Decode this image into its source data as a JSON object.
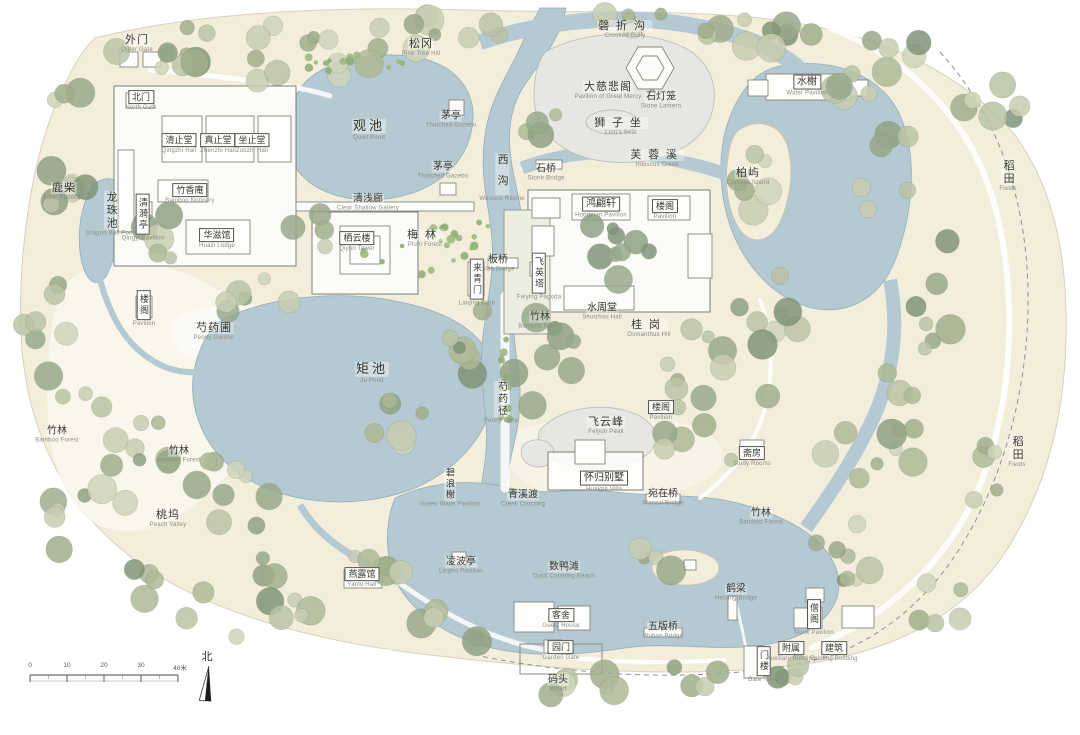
{
  "map": {
    "compass": {
      "label": "北"
    },
    "scale_bar": {
      "ticks": [
        "0",
        "10",
        "20",
        "30"
      ],
      "end_label": "40米"
    },
    "colors": {
      "paper": "#f3eedc",
      "water": "#b4c9d1",
      "rock": "#e6e7e3",
      "tree_greens": [
        "#c7ccb2",
        "#bac3a4",
        "#adb996",
        "#a0ae8c",
        "#cfd3bb"
      ],
      "label_text": "#38382f",
      "label_sub": "#8c8c85"
    },
    "labels": [
      {
        "id": "waimen",
        "zh": "外门",
        "en": "Outer Gate",
        "x": 137,
        "y": 44,
        "size": "m"
      },
      {
        "id": "songgang",
        "zh": "松冈",
        "en": "Pine Tree Hill",
        "x": 421,
        "y": 48,
        "size": "m"
      },
      {
        "id": "qingzhegou",
        "zh": "磬折沟",
        "en": "Crooked Gully",
        "x": 625,
        "y": 30,
        "size": "m",
        "sp": true
      },
      {
        "id": "beimen",
        "zh": "北门",
        "en": "North Gate",
        "x": 141,
        "y": 101,
        "size": "xs",
        "box": true
      },
      {
        "id": "guanchi",
        "zh": "观池",
        "en": "Quiet Pond",
        "x": 369,
        "y": 130,
        "size": "l"
      },
      {
        "id": "maoting-1",
        "zh": "茅亭",
        "en": "Thatched Gazebo",
        "x": 451,
        "y": 120,
        "size": "s"
      },
      {
        "id": "maoting-2",
        "zh": "茅亭",
        "en": "Thatched Gazebo",
        "x": 443,
        "y": 171,
        "size": "s"
      },
      {
        "id": "dacibeige",
        "zh": "大慈悲阁",
        "en": "Pavilion of Great Mercy",
        "x": 608,
        "y": 91,
        "size": "m"
      },
      {
        "id": "shidenglong",
        "zh": "石灯笼",
        "en": "Stone Lantern",
        "x": 661,
        "y": 101,
        "size": "s"
      },
      {
        "id": "shizizuo",
        "zh": "狮子坐",
        "en": "Lion's Seat",
        "x": 621,
        "y": 127,
        "size": "m",
        "sp": true
      },
      {
        "id": "shuixie",
        "zh": "水榭",
        "en": "Water Pavilion",
        "x": 807,
        "y": 86,
        "size": "s",
        "box": true
      },
      {
        "id": "qingzhitang",
        "zh": "清止堂",
        "en": "Qingzhi Hall",
        "x": 179,
        "y": 144,
        "size": "xs",
        "box": true
      },
      {
        "id": "zhenzhitang",
        "zh": "真止堂",
        "en": "Zhenzhi Hall",
        "x": 218,
        "y": 144,
        "size": "xs",
        "box": true
      },
      {
        "id": "zuozhitang",
        "zh": "坐止堂",
        "en": "Zuozhi Hall",
        "x": 252,
        "y": 144,
        "size": "xs",
        "box": true
      },
      {
        "id": "luchai",
        "zh": "鹿柴",
        "en": "Deer Paddock",
        "x": 64,
        "y": 192,
        "size": "m"
      },
      {
        "id": "longzhuchi",
        "zh": "龙珠池",
        "en": "Dragon Ball Pond",
        "x": 111,
        "y": 214,
        "size": "m",
        "v": true
      },
      {
        "id": "qingyiting",
        "zh": "清漪亭",
        "en": "Qingyi Pavilion",
        "x": 143,
        "y": 218,
        "size": "xs",
        "v": true,
        "box": true
      },
      {
        "id": "zhuxiangan",
        "zh": "竹香庵",
        "en": "Bamboo Nunnery",
        "x": 190,
        "y": 194,
        "size": "xs",
        "box": true
      },
      {
        "id": "huaziguan",
        "zh": "华滋馆",
        "en": "Huazi Lodge",
        "x": 217,
        "y": 239,
        "size": "xs",
        "box": true
      },
      {
        "id": "shaoyaopu",
        "zh": "芍药圃",
        "en": "Peony Garden",
        "x": 214,
        "y": 332,
        "size": "m"
      },
      {
        "id": "louge-w",
        "zh": "楼阁",
        "en": "Pavilion",
        "x": 144,
        "y": 309,
        "size": "xs",
        "v": true,
        "box": true
      },
      {
        "id": "qingqianlang",
        "zh": "清浅廊",
        "en": "Clear Shallow Gallery",
        "x": 368,
        "y": 203,
        "size": "s"
      },
      {
        "id": "qiyunlou",
        "zh": "栖云楼",
        "en": "Qiyun Tower",
        "x": 357,
        "y": 242,
        "size": "xs",
        "box": true
      },
      {
        "id": "meilin",
        "zh": "梅林",
        "en": "Plum Forest",
        "x": 425,
        "y": 239,
        "size": "m",
        "sp": true
      },
      {
        "id": "xigou",
        "zh": "西沟",
        "en": "Western Ravine",
        "x": 502,
        "y": 178,
        "size": "m",
        "v": true,
        "sp": true
      },
      {
        "id": "shiqiao",
        "zh": "石桥",
        "en": "Stone Bridge",
        "x": 546,
        "y": 173,
        "size": "s"
      },
      {
        "id": "furongxi",
        "zh": "芙蓉溪",
        "en": "Hibiscus Creek",
        "x": 657,
        "y": 159,
        "size": "m",
        "sp": true
      },
      {
        "id": "boyu",
        "zh": "柏屿",
        "en": "Cypress Island",
        "x": 748,
        "y": 177,
        "size": "m"
      },
      {
        "id": "hongpianxuan",
        "zh": "鸿翩轩",
        "en": "Hongpian Pavilion",
        "x": 601,
        "y": 208,
        "size": "s",
        "box": true
      },
      {
        "id": "louge-ne",
        "zh": "楼阁",
        "en": "Pavilion",
        "x": 665,
        "y": 210,
        "size": "xs",
        "box": true
      },
      {
        "id": "banqiao",
        "zh": "板桥",
        "en": "Slab Bridge",
        "x": 498,
        "y": 264,
        "size": "s"
      },
      {
        "id": "laiqingmen",
        "zh": "来青门",
        "en": "Laiqing Gate",
        "x": 477,
        "y": 283,
        "size": "xs",
        "v": true,
        "box": true
      },
      {
        "id": "feiyingta",
        "zh": "飞英塔",
        "en": "Feiying Pagoda",
        "x": 539,
        "y": 277,
        "size": "xs",
        "v": true,
        "box": true
      },
      {
        "id": "zhulin-c",
        "zh": "竹林",
        "en": "Bamboo Forest",
        "x": 540,
        "y": 321,
        "size": "s"
      },
      {
        "id": "shuizhoutang",
        "zh": "水周堂",
        "en": "Shuizhou Hall",
        "x": 602,
        "y": 312,
        "size": "s"
      },
      {
        "id": "guigang",
        "zh": "桂岗",
        "en": "Osmanthus Hill",
        "x": 649,
        "y": 329,
        "size": "m",
        "sp": true
      },
      {
        "id": "juchi",
        "zh": "矩池",
        "en": "Ju Pond",
        "x": 372,
        "y": 373,
        "size": "l"
      },
      {
        "id": "shaoyaojing",
        "zh": "芍药径",
        "en": "Peony Lane",
        "x": 501,
        "y": 403,
        "size": "s",
        "v": true
      },
      {
        "id": "louge-se",
        "zh": "楼阁",
        "en": "Pavilion",
        "x": 661,
        "y": 411,
        "size": "xs",
        "box": true
      },
      {
        "id": "feiyunfeng",
        "zh": "飞云峰",
        "en": "Feiyun Peak",
        "x": 606,
        "y": 426,
        "size": "m"
      },
      {
        "id": "zhaifang",
        "zh": "斋房",
        "en": "Study Rooms",
        "x": 752,
        "y": 457,
        "size": "xs",
        "box": true
      },
      {
        "id": "bilangxie",
        "zh": "碧浪榭",
        "en": "Green Wave Pavilion",
        "x": 450,
        "y": 488,
        "size": "xs",
        "v": true
      },
      {
        "id": "qingxidu",
        "zh": "青溪渡",
        "en": "Creek Crossing",
        "x": 523,
        "y": 499,
        "size": "s"
      },
      {
        "id": "huaiguibieshu",
        "zh": "怀归别墅",
        "en": "Huaigui Villa",
        "x": 604,
        "y": 482,
        "size": "s",
        "box": true
      },
      {
        "id": "wanzaiqiao",
        "zh": "宛在桥",
        "en": "Wanzai Bridge",
        "x": 663,
        "y": 498,
        "size": "s"
      },
      {
        "id": "zhulin-se",
        "zh": "竹林",
        "en": "Bamboo Forest",
        "x": 761,
        "y": 517,
        "size": "s"
      },
      {
        "id": "zhulin-w1",
        "zh": "竹林",
        "en": "Bamboo Forest",
        "x": 57,
        "y": 435,
        "size": "s"
      },
      {
        "id": "zhulin-w2",
        "zh": "竹林",
        "en": "Bamboo Forest",
        "x": 179,
        "y": 455,
        "size": "s"
      },
      {
        "id": "taowu",
        "zh": "桃坞",
        "en": "Peach Valley",
        "x": 168,
        "y": 519,
        "size": "m"
      },
      {
        "id": "yanluguan",
        "zh": "燕露馆",
        "en": "Yanlu Hall",
        "x": 362,
        "y": 578,
        "size": "xs",
        "box": true
      },
      {
        "id": "lingboting",
        "zh": "凌波亭",
        "en": "Lingbo Pavilion",
        "x": 461,
        "y": 566,
        "size": "s"
      },
      {
        "id": "shuyatan",
        "zh": "数鸭滩",
        "en": "Duck Counting Beach",
        "x": 564,
        "y": 571,
        "size": "s"
      },
      {
        "id": "heliang",
        "zh": "鹤梁",
        "en": "Heliang Bridge",
        "x": 736,
        "y": 593,
        "size": "s"
      },
      {
        "id": "keshe",
        "zh": "客舍",
        "en": "Guest House",
        "x": 561,
        "y": 619,
        "size": "xs",
        "box": true
      },
      {
        "id": "wubanqiao",
        "zh": "五版桥",
        "en": "Wuban Bridge",
        "x": 663,
        "y": 631,
        "size": "s"
      },
      {
        "id": "yuanmen",
        "zh": "园门",
        "en": "Garden Gate",
        "x": 561,
        "y": 651,
        "size": "xs",
        "box": true
      },
      {
        "id": "matou",
        "zh": "码头",
        "en": "Wharf",
        "x": 558,
        "y": 684,
        "size": "s"
      },
      {
        "id": "menlou",
        "zh": "门楼",
        "en": "Gate Tower",
        "x": 764,
        "y": 665,
        "size": "xs",
        "v": true,
        "box": true
      },
      {
        "id": "sengge",
        "zh": "僧阁",
        "en": "Monk Pavilion",
        "x": 814,
        "y": 618,
        "size": "xs",
        "v": true,
        "box": true
      },
      {
        "id": "fushu",
        "zh": "附属",
        "en": "Auxiliary Building",
        "x": 791,
        "y": 652,
        "size": "xs",
        "box": true
      },
      {
        "id": "jianzhu",
        "zh": "建筑",
        "en": "Existing Building",
        "x": 834,
        "y": 652,
        "size": "xs",
        "box": true
      },
      {
        "id": "daotian-n",
        "zh": "稻田",
        "en": "Fields",
        "x": 1008,
        "y": 176,
        "size": "m",
        "v": true
      },
      {
        "id": "daotian-s",
        "zh": "稻田",
        "en": "Fields",
        "x": 1017,
        "y": 452,
        "size": "m",
        "v": true
      }
    ]
  }
}
